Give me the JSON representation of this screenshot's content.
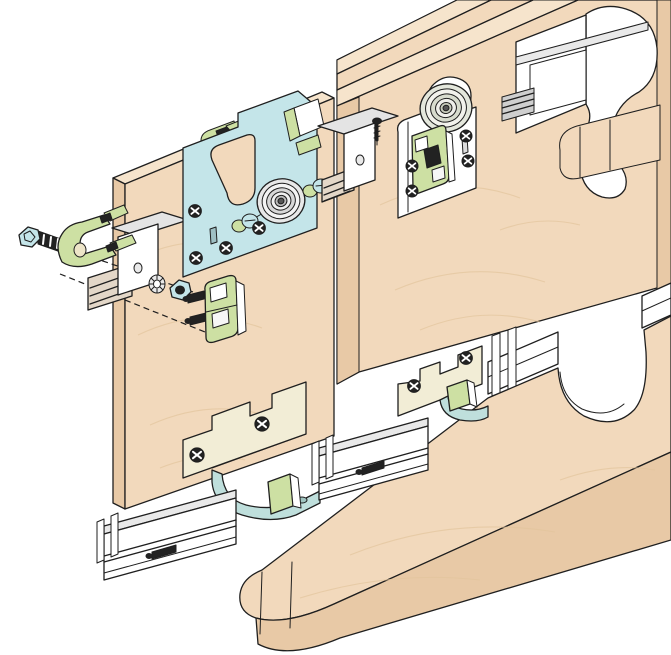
{
  "diagram": {
    "kind": "exploded-assembly-illustration",
    "subject": "sliding-door-roller-hardware",
    "parts": [
      {
        "id": "cabinet-top-panel",
        "material": "wood"
      },
      {
        "id": "upper-track-cutaway",
        "material": "aluminium"
      },
      {
        "id": "door-panel-left",
        "material": "wood"
      },
      {
        "id": "door-panel-right",
        "material": "wood"
      },
      {
        "id": "roller-assembly-front",
        "material": "steel",
        "finish": "blue"
      },
      {
        "id": "roller-assembly-rear",
        "material": "steel",
        "finish": "white"
      },
      {
        "id": "mounting-bracket-left",
        "material": "steel"
      },
      {
        "id": "mounting-bracket-right",
        "material": "steel"
      },
      {
        "id": "hex-bolt",
        "finish": "blue-head"
      },
      {
        "id": "clamp-fitting",
        "finish": "green"
      },
      {
        "id": "serrated-washer",
        "material": "steel"
      },
      {
        "id": "hex-nut",
        "finish": "blue"
      },
      {
        "id": "fixing-block",
        "finish": "green"
      },
      {
        "id": "upper-track-section-left",
        "material": "aluminium"
      },
      {
        "id": "upper-track-section-right",
        "material": "aluminium"
      },
      {
        "id": "bottom-guide-front",
        "finish": "cream-teal"
      },
      {
        "id": "bottom-guide-rear",
        "finish": "cream-teal"
      },
      {
        "id": "bottom-track-installed",
        "material": "aluminium"
      },
      {
        "id": "bottom-track-segment-a",
        "material": "aluminium"
      },
      {
        "id": "bottom-track-segment-b",
        "material": "aluminium"
      },
      {
        "id": "cabinet-bottom-panel",
        "material": "wood"
      }
    ]
  },
  "colors": {
    "background": "#FFFFFF",
    "line": "#1F1F1F",
    "wood": "#F2D9BC",
    "woodEdge": "#E8C9A6",
    "woodTop": "#F6E4CC",
    "grain": "#E2C49D",
    "hwBlue": "#C4E5E9",
    "hwGreen": "#CDE0A3",
    "cream": "#F2EDD6",
    "teal": "#BFDFDC",
    "white": "#FFFFFF",
    "lightGray": "#E9E9E9",
    "midGray": "#CFCFCF",
    "steel": "#E4E4E4",
    "dark": "#222222"
  }
}
